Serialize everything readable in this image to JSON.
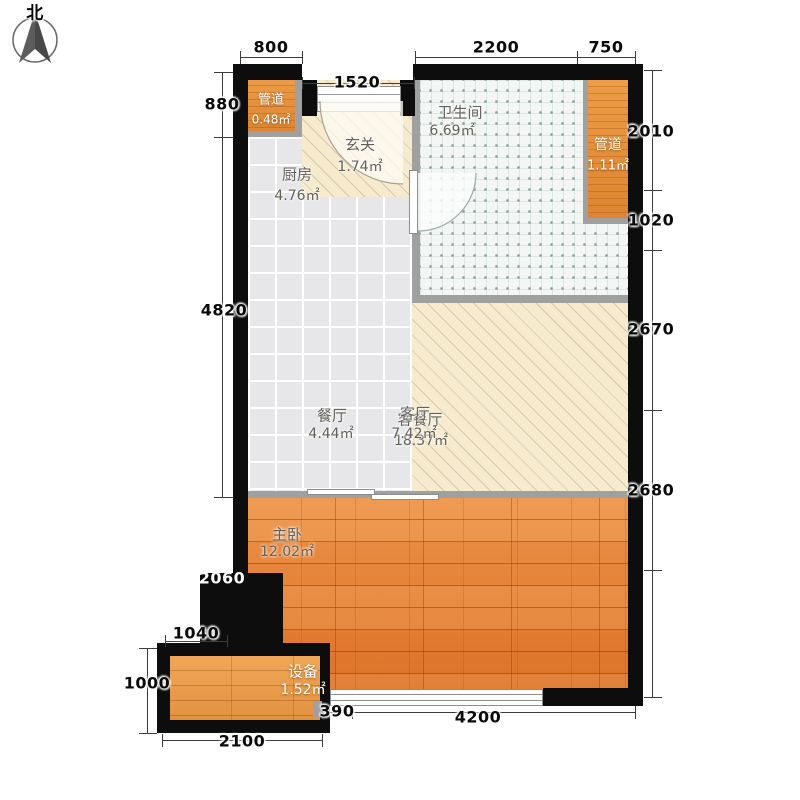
{
  "compass": {
    "north_label": "北"
  },
  "rooms": {
    "duct_tl": {
      "name": "管道",
      "area": "0.48㎡"
    },
    "entry": {
      "name": "玄关",
      "area": "1.74㎡"
    },
    "kitchen": {
      "name": "厨房",
      "area": "4.76㎡"
    },
    "bathroom": {
      "name": "卫生间",
      "area": "6.69㎡"
    },
    "duct_right": {
      "name": "管道",
      "area": "1.11㎡"
    },
    "dining": {
      "name": "餐厅",
      "area": "4.44㎡"
    },
    "living": {
      "name": "客厅",
      "area": "7.42㎡"
    },
    "living_dining_combined": {
      "name": "客餐厅",
      "area": "18.37㎡"
    },
    "master_bedroom": {
      "name": "主卧",
      "area": "12.02㎡"
    },
    "equipment": {
      "name": "设备",
      "area": "1.52㎡"
    }
  },
  "dimensions_mm": {
    "top": {
      "d800": "800",
      "d2200": "2200",
      "d750": "750",
      "d1520": "1520"
    },
    "left": {
      "d880": "880",
      "d4820": "4820",
      "d2060": "2060",
      "d1040": "1040",
      "d1000": "1000"
    },
    "right": {
      "d2010": "2010",
      "d1020": "1020",
      "d2670": "2670",
      "d2680": "2680"
    },
    "bottom": {
      "d2100": "2100",
      "d390": "390",
      "d4200": "4200"
    }
  },
  "colors": {
    "outer_wall": "#0d0d0d",
    "partition_wall": "#a0a0a0",
    "wood_floor": "#e07a30",
    "hatch_beige": "#f7ebcf",
    "tile_gray": "#e7e7e9",
    "tile_bath": "#f3f6f4"
  }
}
